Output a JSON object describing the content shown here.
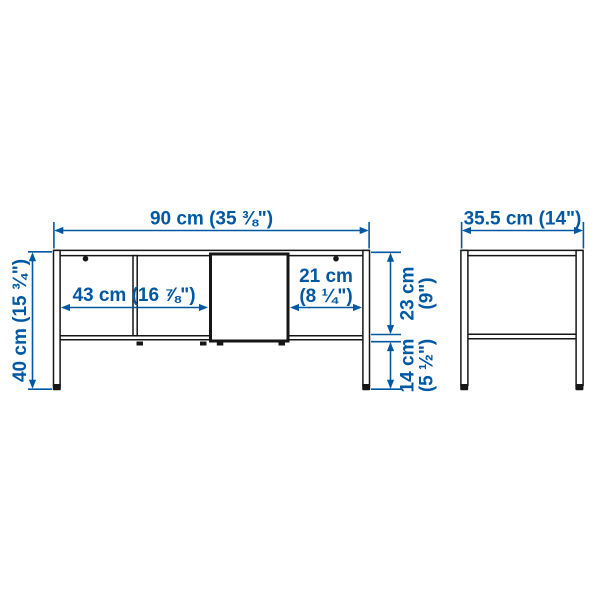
{
  "colors": {
    "dimension_blue": "#0058a3",
    "line_dark": "#161616",
    "background": "#ffffff"
  },
  "front_view": {
    "width_label": "90 cm (35 ⅜\")",
    "height_label": "40 cm (15 ¾\")",
    "inner_width_label": "43 cm (16 ⅞\")",
    "door_opening_label_line1": "21 cm",
    "door_opening_label_line2": "(8 ¼\")",
    "upper_section_label_line1": "23 cm",
    "upper_section_label_line2": "(9\")",
    "leg_clearance_label_line1": "14 cm",
    "leg_clearance_label_line2": "(5 ½\")"
  },
  "side_view": {
    "depth_label": "35.5 cm (14\")"
  }
}
